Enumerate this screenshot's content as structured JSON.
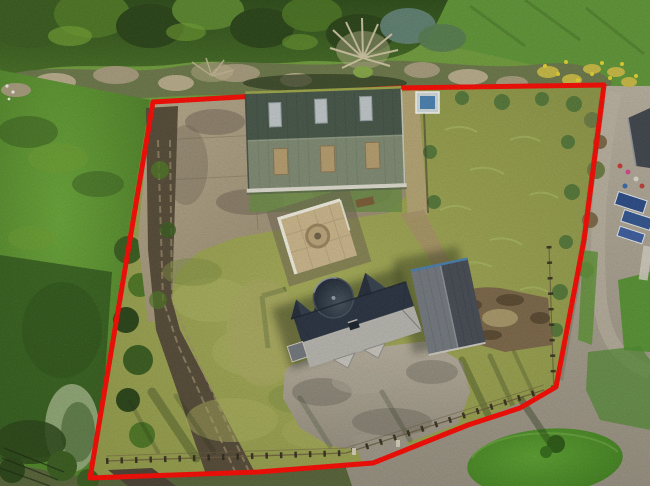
{
  "meta": {
    "type": "aerial-photograph",
    "subject": "rural property with house, large green shed, garage and paddocks outlined by a red site-boundary overlay",
    "view": "top-down drone view"
  },
  "boundary": {
    "points": "153,102 398,88 604,85 584,240 556,387 520,408 468,425 373,463 258,472 90,478",
    "color": "#f20d06",
    "stroke_width": "5"
  },
  "palette": {
    "boundary_red": "#f20d06",
    "canopy_dark": "#2c451a",
    "canopy_mid": "#4e7526",
    "canopy_light": "#6f9c33",
    "field_green": "#5f9734",
    "field_shadow": "#30531d",
    "scrub_tan": "#b4a88a",
    "concrete_yard": "#a89a7e",
    "concrete_stain": "#6d6153",
    "track_brown": "#564b39",
    "paddock_olive": "#99a151",
    "rough_green": "#729a44",
    "dirt_brown": "#7a664a",
    "barn_roof_dark": "#47564a",
    "barn_roof_light": "#7d8872",
    "skylight_grey": "#c6ccd1",
    "roof_panel_tan": "#b59c6e",
    "house_slate_dark": "#2b3442",
    "house_slate_light": "#b3b1ac",
    "garage_roof_light": "#72777e",
    "garage_roof_dark": "#474c55",
    "patio_tan": "#c6b28a",
    "wall_white": "#ebe7db",
    "tarmac_grey": "#a59c8b",
    "island_green": "#4c8b28",
    "gorse_yellow": "#dfcd33",
    "fence_dark": "#2f2a1c"
  },
  "objects": {
    "barn": "green corrugated shed with three rooflights per slope",
    "house": "slate-roofed house with round turret and gable dormers",
    "garage": "detached dual-pitch garage",
    "patio": "walled paving court with circular motif",
    "left_paddock": "rough olive grass enclosure",
    "right_paddock": "overgrown grass enclosure with bare-earth patch",
    "concrete_yard": "stained concrete yard",
    "farm_track": "dirt farm track along west boundary",
    "driveway": "tarmac turning loop with grass island",
    "hedgerow": "scrub hedgerow with gorse",
    "tree_belt": "mature tree belt along north edge",
    "fence": "timber post-and-rail stock fence"
  }
}
